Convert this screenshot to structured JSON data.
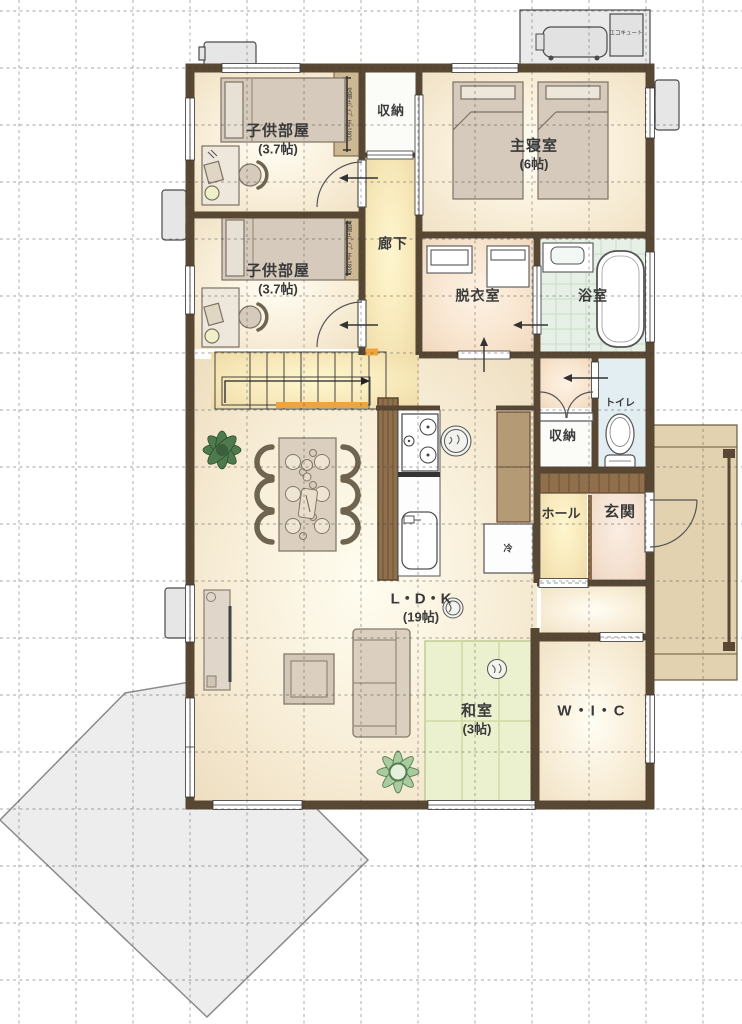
{
  "plan": {
    "title": "1F floor plan",
    "rooms": {
      "kids_room_1": {
        "label": "子供部屋",
        "size": "(3.7帖)"
      },
      "kids_room_2": {
        "label": "子供部屋",
        "size": "(3.7帖)"
      },
      "storage_top": {
        "label": "収納"
      },
      "master_bedroom": {
        "label": "主寝室",
        "size": "(6帖)"
      },
      "corridor": {
        "label": "廊下"
      },
      "dressing_room": {
        "label": "脱衣室"
      },
      "bathroom": {
        "label": "浴室"
      },
      "toilet": {
        "label": "トイレ"
      },
      "storage_mid": {
        "label": "収納"
      },
      "hall": {
        "label": "ホール"
      },
      "entrance": {
        "label": "玄関"
      },
      "ldk": {
        "label": "L・D・K",
        "size": "(19帖)"
      },
      "washitsu": {
        "label": "和室",
        "size": "(3帖)"
      },
      "wic": {
        "label": "W・I・C"
      }
    },
    "annotations": {
      "ecocute": "エコキュート",
      "closet_note_1": "枕棚+ﾊﾟｲﾌﾟ H=1800",
      "closet_note_2": "枕棚+ﾊﾟｲﾌﾟ H=1800",
      "fridge": "冷"
    },
    "colors": {
      "wall": "#584732",
      "floor_wood": "#f2e3c4",
      "tatami": "#ebf1cf",
      "bath_floor": "#e7f0e6",
      "toilet_floor": "#e3eef3",
      "entrance_floor": "#f0d6c2",
      "porch": "#e3d2b0",
      "deck": "#ededed",
      "stair_accent": "#f2a43c",
      "furniture": "#dbcfbf"
    }
  }
}
